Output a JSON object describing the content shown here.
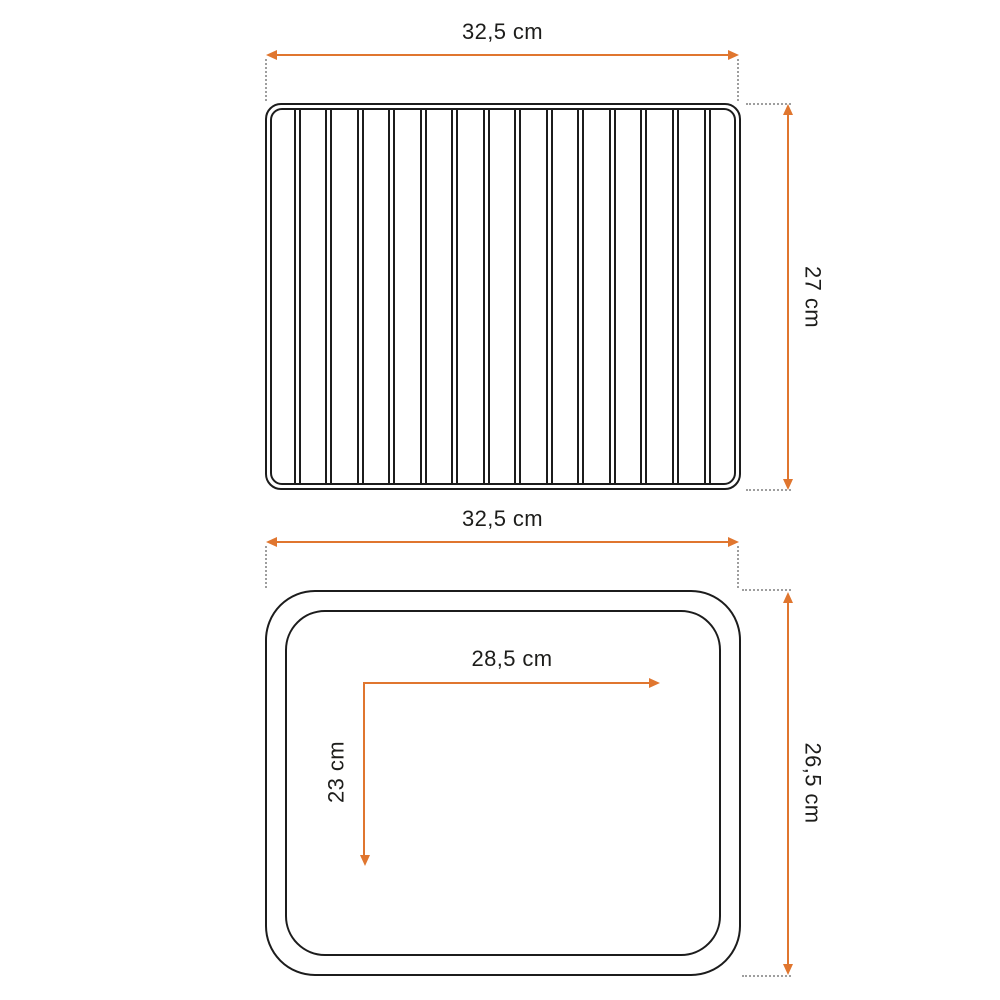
{
  "colors": {
    "accent_orange": "#e0762f",
    "outline_black": "#1c1c1c",
    "extension_gray": "#9e9e9e",
    "text": "#1d1d1b",
    "background": "#ffffff"
  },
  "figures": {
    "rack": {
      "kind": "wire-rack-top-view",
      "bar_count": 14,
      "width_label": "32,5 cm",
      "height_label": "27 cm"
    },
    "tray": {
      "kind": "baking-tray-top-view",
      "width_label": "32,5 cm",
      "height_label": "26,5 cm",
      "inner_width_label": "28,5 cm",
      "inner_height_label": "23 cm"
    }
  }
}
